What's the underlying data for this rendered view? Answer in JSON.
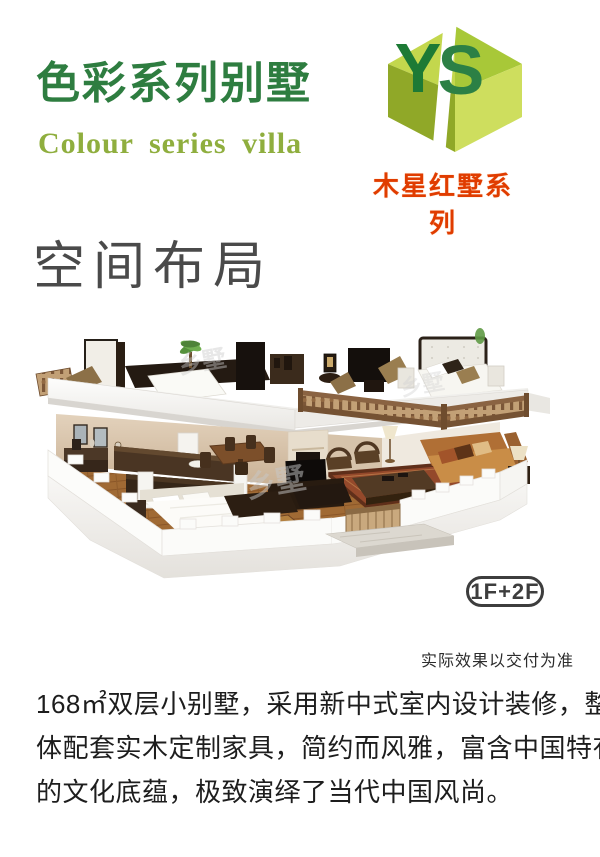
{
  "header": {
    "title_cn": "色彩系列别墅",
    "title_en": "Colour series villa",
    "colors": {
      "title_cn": "#2e7d40",
      "title_en": "#8fae3e"
    }
  },
  "logo": {
    "icon": "ys-cube-logo-icon",
    "letter_y": "Y",
    "letter_s": "S",
    "series_label": "木星红墅系列",
    "colors": {
      "letter_y": "#1d7a35",
      "letter_s": "#2c8045",
      "series_label": "#e03c00",
      "facets": [
        "#c3d74d",
        "#a8c838",
        "#90a828",
        "#cede5e"
      ]
    }
  },
  "section": {
    "heading": "空间布局",
    "heading_color": "#4a4a4a"
  },
  "villa_figure": {
    "illustration": "two-storey-villa-cutaway-3d-interior-render",
    "floors_badge": "1F+2F",
    "disclaimer": "实际效果以交付为准",
    "watermark": "乡墅"
  },
  "description": {
    "full_text": "168㎡双层小别墅，采用新中式室内设计装修，整体配套实木定制家具，简约而风雅，富含中国特有的文化底蕴，极致演绎了当代中国风尚。",
    "lines": [
      "168㎡双层小别墅，采用新中式室内设计装修，整",
      "体配套实木定制家具，简约而风雅，富含中国特有",
      "的文化底蕴，极致演绎了当代中国风尚。"
    ]
  }
}
